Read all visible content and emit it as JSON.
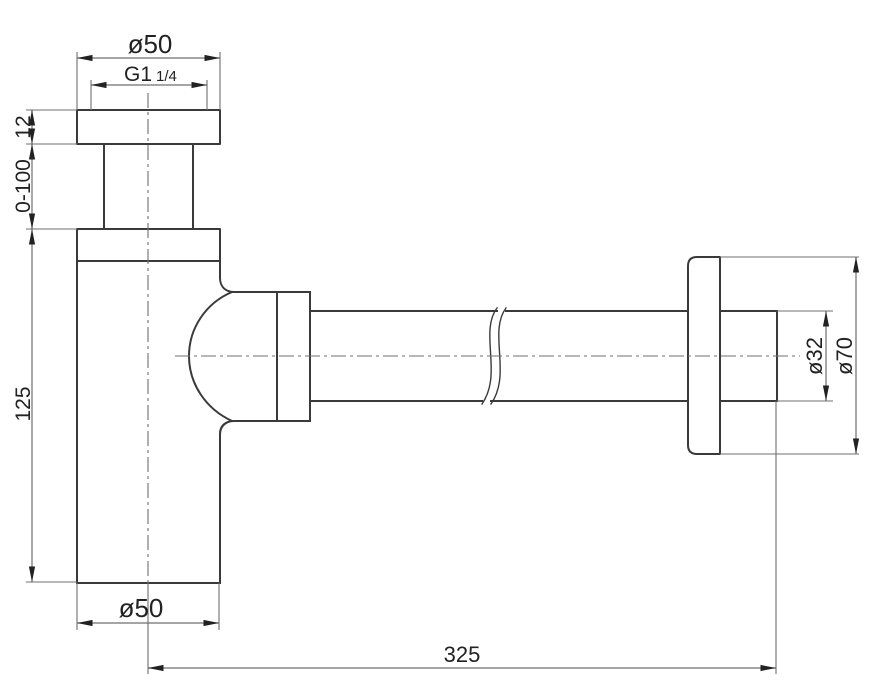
{
  "drawing": {
    "background": "#ffffff",
    "colors": {
      "outline": "#3a3a3a",
      "dimension_lines": "#6f6f6f",
      "text": "#222222"
    },
    "labels": {
      "flange_diameter_top": "ø50",
      "thread_size_base": "G1",
      "thread_size_fraction": "1/4",
      "flange_thickness": "12",
      "tube_adjustable_length": "0-100",
      "body_height": "125",
      "body_diameter_bottom": "ø50",
      "horizontal_length": "325",
      "pipe_diameter": "ø32",
      "wall_flange_diameter": "ø70"
    }
  }
}
